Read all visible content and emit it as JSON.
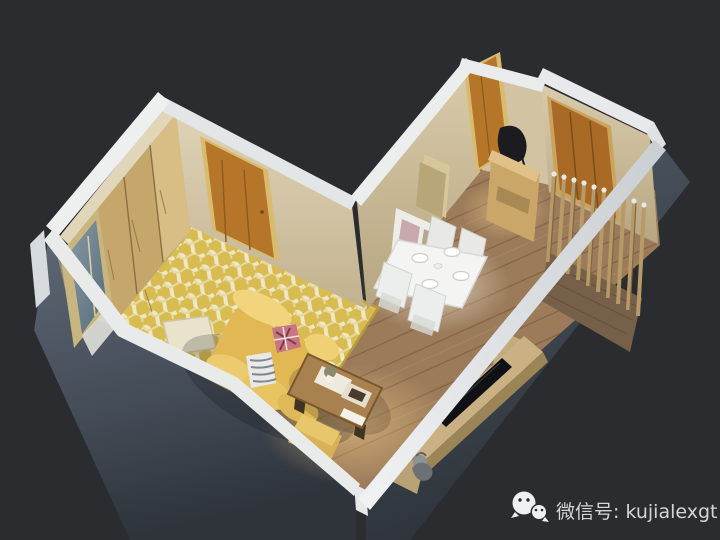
{
  "meta": {
    "description": "3D isometric cutaway render of a small L-shaped apartment (living/bedroom wing with yellow rug and sofa, dining-hallway wing with white dining set, TV wall and wooden slat screen) on a dark background",
    "background_color": "#2a2c30"
  },
  "watermark": {
    "icon": "wechat-icon",
    "label": "微信号: kujialexgt",
    "color": "#d3d6d9"
  },
  "scene": {
    "rooms": [
      {
        "name": "living-bedroom-wing",
        "floor": "yellow patterned rug over light wood"
      },
      {
        "name": "dining-hallway-wing",
        "floor": "brown wood planks"
      }
    ],
    "objects": [
      "wardrobe",
      "window",
      "bedroom-door",
      "entry-door",
      "second-door",
      "patterned-rug",
      "floor-cushion",
      "yellow-sofa",
      "pink-pillow",
      "striped-pillow",
      "coffee-table",
      "ottoman",
      "dining-table",
      "dining-chairs",
      "dinner-plates",
      "shelf-unit",
      "tall-cabinet",
      "console-table",
      "slat-screen",
      "tv-cabinet",
      "tv",
      "statue"
    ],
    "counts": {
      "dinner_plates": 4,
      "dining_chairs": 4,
      "doors": 3
    },
    "palette": {
      "background": "#2a2c30",
      "wall_cap_white": "#e9ebec",
      "wall_cream": "#d8cdb2",
      "wall_exterior_slate": "#4e5764",
      "door_wood": "#b5762a",
      "wardrobe_tan": "#c5a76b",
      "rug_yellow": "#d8bc52",
      "rug_wave_cream": "#efe7c6",
      "sofa_yellow": "#e8c05e",
      "floor_wood": "#9b7b5a",
      "dining_white": "#f4f5f2",
      "slat_wood": "#b79a68",
      "tv_black": "#101114",
      "glass_blue": "#6d8494"
    }
  }
}
